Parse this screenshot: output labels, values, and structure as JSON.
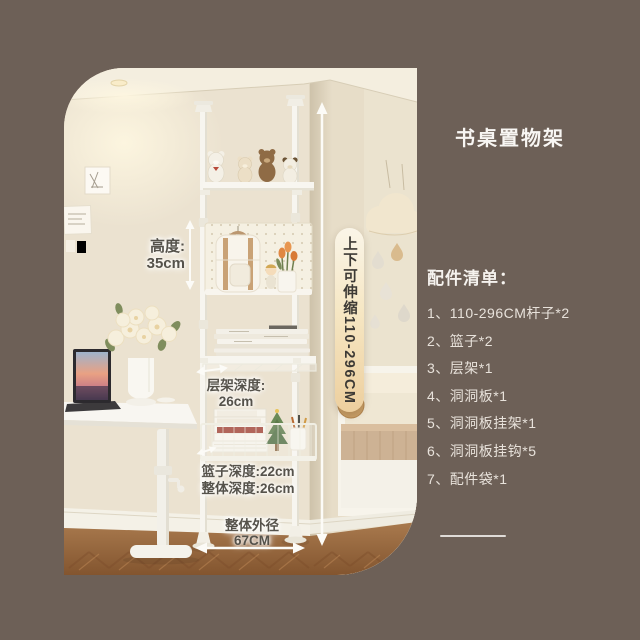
{
  "colors": {
    "background": "#6d6057",
    "capsule_gradient_top": "#faf5e8",
    "capsule_gradient_bottom": "#edcf9e",
    "annotation_text": "#55524b",
    "panel_text": "#f5f2ee",
    "measure_arrow": "#fcfbf7"
  },
  "title": "书桌置物架",
  "photo": {
    "annotations": {
      "height_label": "高度:",
      "height_value": "35cm",
      "capsule_text": "上下可伸缩110-296CM",
      "shelf_depth_label": "层架深度:",
      "shelf_depth_value": "26cm",
      "basket_depth": "篮子深度:22cm",
      "overall_depth": "整体深度:26cm",
      "outer_width_label": "整体外径",
      "outer_width_value": "67CM"
    }
  },
  "panel": {
    "list_header": "配件清单：",
    "items": [
      "1、110-296CM杆子*2",
      "2、篮子*2",
      "3、层架*1",
      "4、洞洞板*1",
      "5、洞洞板挂架*1",
      "6、洞洞板挂钩*5",
      "7、配件袋*1"
    ]
  }
}
